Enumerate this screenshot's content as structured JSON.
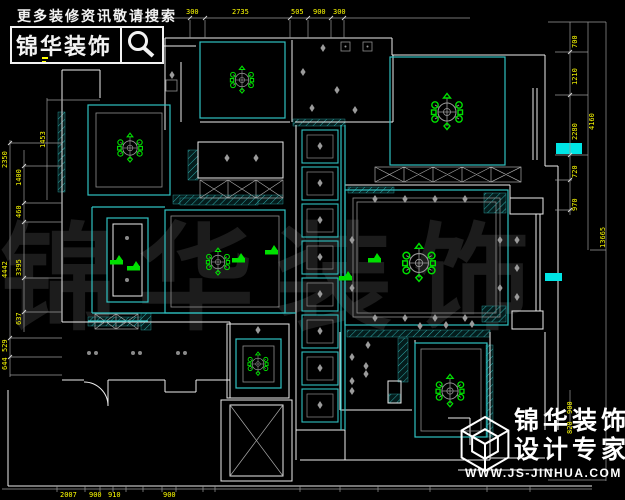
{
  "header": {
    "tagline": "更多装修资讯敬请搜索",
    "brand": "锦华装饰"
  },
  "footer": {
    "brand": "锦华装饰",
    "subtitle": "设计专家",
    "website": "WWW.JS-JINHUA.COM"
  },
  "watermark": "锦华装饰",
  "colors": {
    "background": "#000000",
    "wall_white": "#ececec",
    "ceiling_frame_cyan": "#2fc1c1",
    "lamp_green": "#00e000",
    "downlight_gray": "#9a9a9a",
    "dimension_yellow": "#ffff00",
    "window_fill_cyan": "#00e5e5",
    "watermark_gray": "#1c1c1c"
  },
  "icons": {
    "search": "magnifier-icon",
    "chandelier": "ceiling-chandelier-symbol",
    "downlight": "diamond-downlight-symbol",
    "cube_logo": "wireframe-cube-logo-icon",
    "door": "quarter-arc-door-swing",
    "elevator": "x-cross-shaft"
  },
  "dimensions": {
    "top": [
      "300",
      "2735",
      "505",
      "900",
      "300"
    ],
    "left": [
      "1453",
      "2350",
      "1400",
      "460",
      "3395",
      "4442",
      "637",
      "529",
      "644"
    ],
    "right": [
      "700",
      "1210",
      "2280",
      "720",
      "970",
      "4160",
      "13665",
      "900",
      "820"
    ],
    "bottom": [
      "2007",
      "900",
      "910",
      "900"
    ]
  }
}
